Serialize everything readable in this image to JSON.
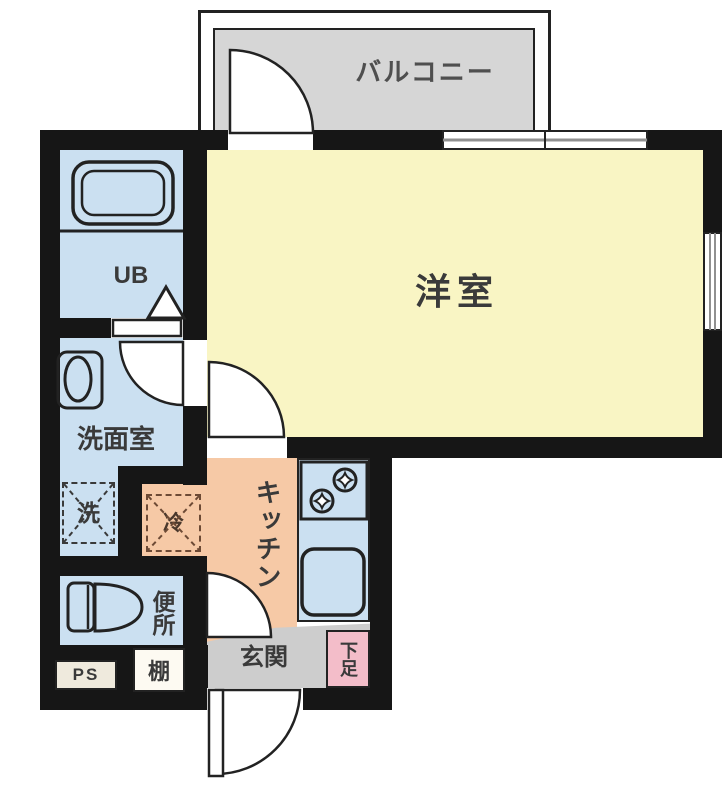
{
  "plan": {
    "rooms": {
      "balcony": "バルコニー",
      "western_room": "洋室",
      "unit_bath": "UB",
      "washroom": "洗面室",
      "kitchen": "キッチン",
      "toilet": "便所",
      "entrance": "玄関"
    },
    "fixtures": {
      "washer": "洗",
      "fridge": "冷",
      "shoe_cabinet": "下足",
      "shelf": "棚",
      "pipe_space": "PS"
    },
    "colors": {
      "wall": "#161616",
      "room_yellow": "#f9f5c4",
      "wet_area_blue": "#cbe0f1",
      "kitchen_salmon": "#f6c9a6",
      "shoe_cabinet_pink": "#f3bdc9",
      "balcony_gray": "#d6d6d6",
      "entrance_gray": "#cdcdcd",
      "text": "#3a3a3a"
    }
  }
}
